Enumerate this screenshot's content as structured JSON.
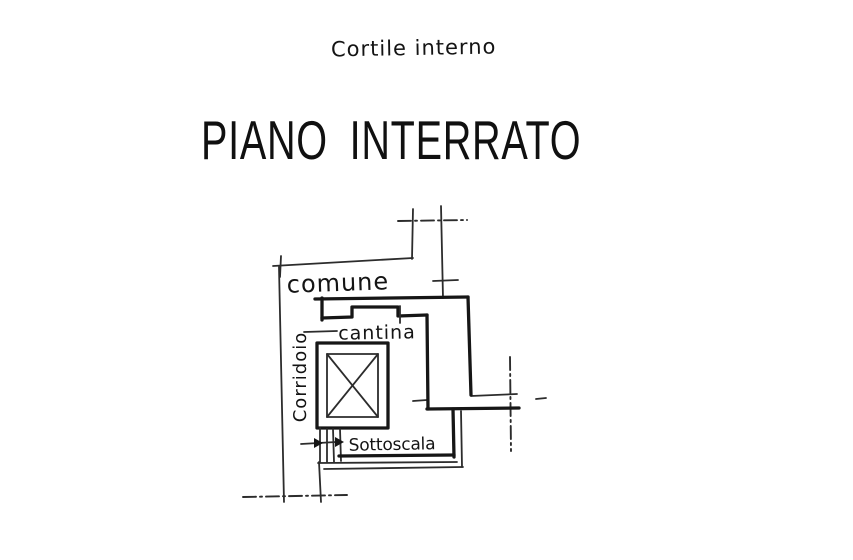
{
  "document": {
    "background": "#ffffff",
    "ink_color": "#1f1f1f",
    "top_label": "Cortile interno",
    "title": "PIANO INTERRATO"
  },
  "floor_plan": {
    "labels": {
      "common": "comune",
      "cellar": "cantina",
      "corridor": "Corridoio",
      "understairs": "Sottoscala"
    }
  }
}
